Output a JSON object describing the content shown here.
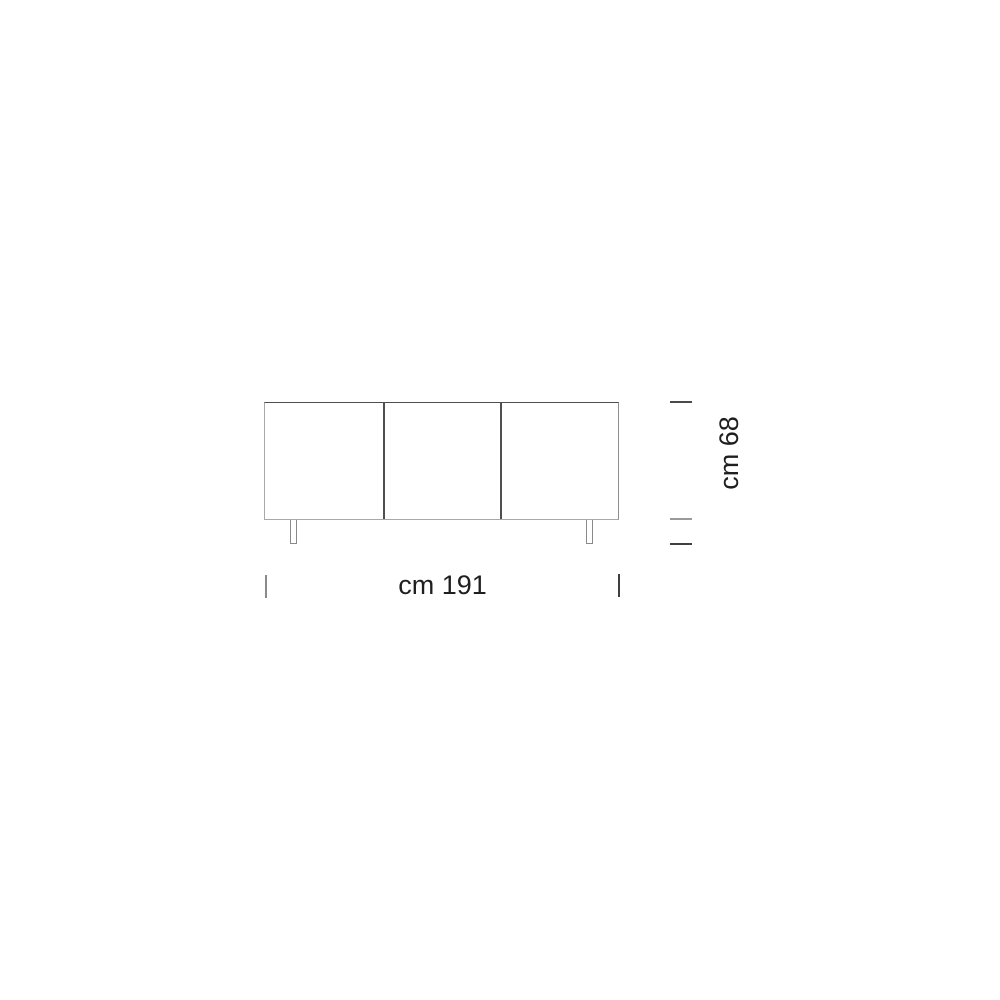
{
  "figure": {
    "type": "furniture-dimension-diagram",
    "subject": "three-door sideboard, front elevation",
    "door_count": 3,
    "leg_count": 2
  },
  "dimensions": {
    "width_label": "cm 191",
    "height_label": "cm 68"
  },
  "colors": {
    "background": "#ffffff",
    "outline_light": "#a8a8a8",
    "outline_dark": "#4f4f4f",
    "tick_light": "#9a9a9a",
    "tick_dark": "#3f3f3f",
    "text": "#1f1f1f"
  }
}
